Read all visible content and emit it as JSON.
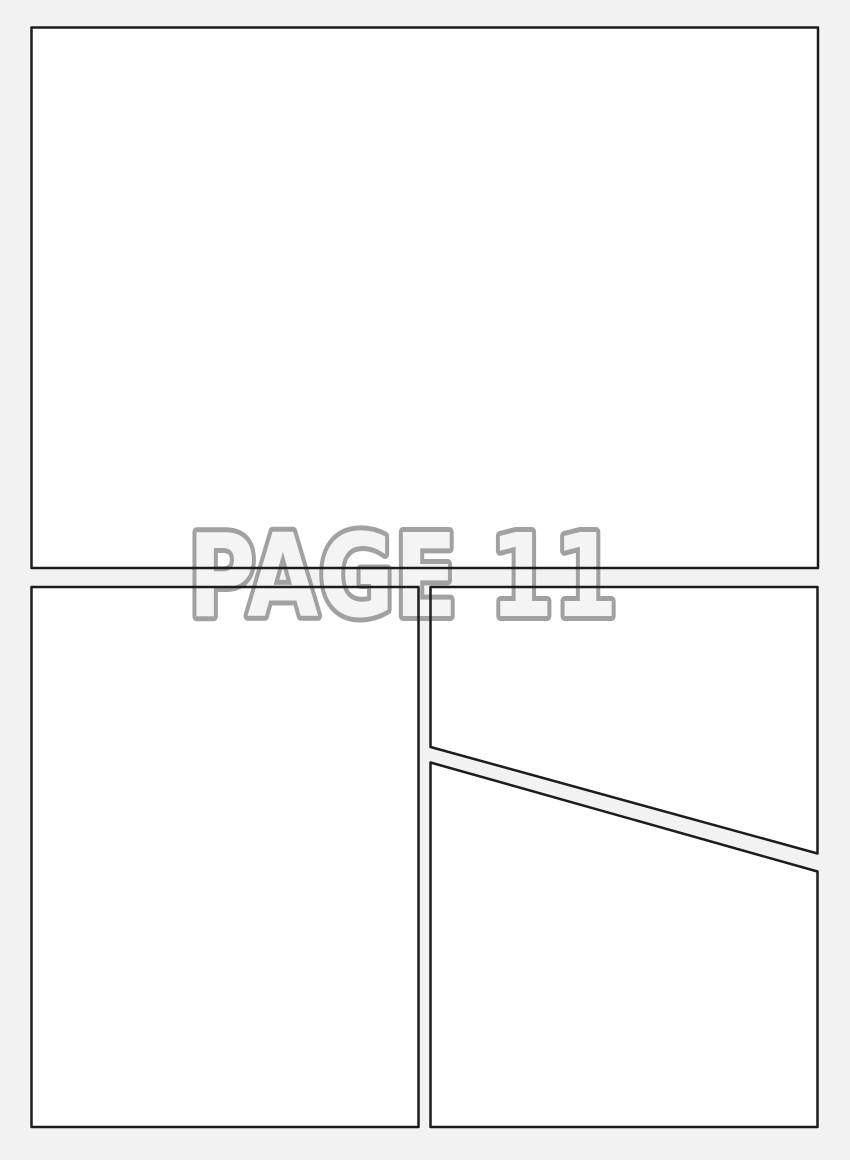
{
  "page": {
    "label": "PAGE 11"
  },
  "colors": {
    "background": "#f2f2f2",
    "panel_fill": "#ffffff",
    "panel_border": "#1c1c1c",
    "label_fill": "#f4f4f4",
    "label_outline": "#a1a1a1"
  },
  "panels": [
    {
      "id": "panel-1",
      "position": "top-full-width"
    },
    {
      "id": "panel-2",
      "position": "bottom-left"
    },
    {
      "id": "panel-3",
      "position": "bottom-right-upper-diagonal"
    },
    {
      "id": "panel-4",
      "position": "bottom-right-lower-diagonal"
    }
  ]
}
